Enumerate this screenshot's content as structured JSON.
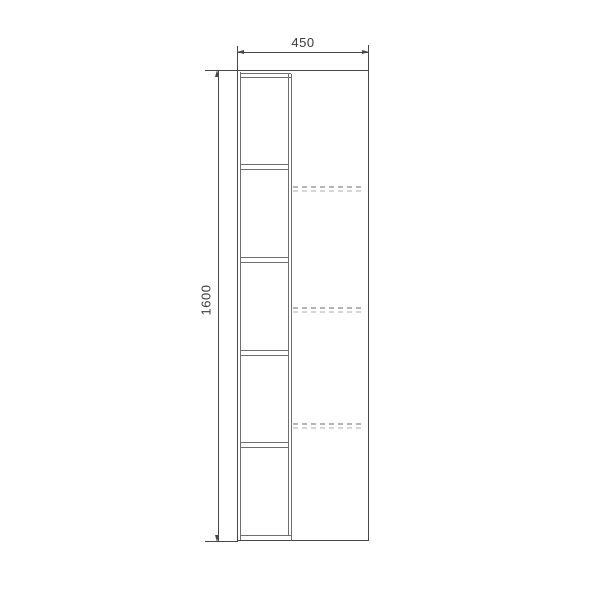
{
  "drawing": {
    "type": "furniture front elevation, dimensioned technical drawing",
    "width_label": "450",
    "height_label": "1600",
    "line_color": "#474747",
    "dash_color": "#b5b5b5",
    "open_compartments": 5,
    "hidden_shelves": 3
  },
  "figure": {
    "shelf_y": [
      164,
      257,
      350,
      442
    ],
    "hidden_shelf_y": [
      186,
      307,
      423
    ]
  }
}
